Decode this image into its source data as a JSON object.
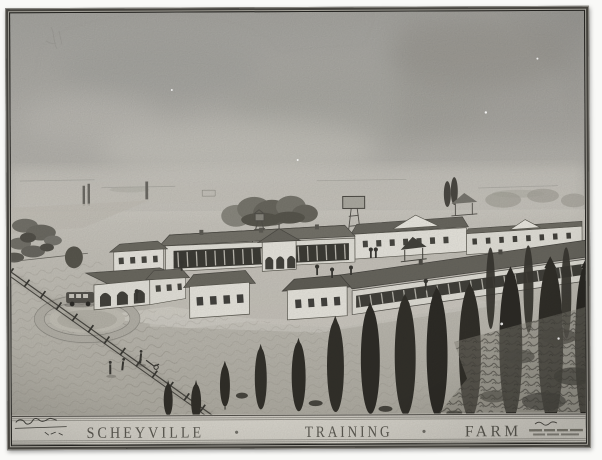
{
  "artwork": {
    "title_band": {
      "word_left": "SCHEYVILLE",
      "word_middle": "TRAINING",
      "word_right": "FARM",
      "separator": "●",
      "signature_left": "(illegible handwritten signature)",
      "inscription_right": "(illegible small inscription)"
    },
    "colors": {
      "frame": "#2b2a26",
      "paper_sky": "#b5b4af",
      "paper_light": "#d0cdc5",
      "building_wall": "#eceae2",
      "building_roof": "#716f66",
      "window_band": "#43423c",
      "tree_dark": "#32302a",
      "title_band": "#dedbd2",
      "title_text": "#55534b"
    }
  }
}
